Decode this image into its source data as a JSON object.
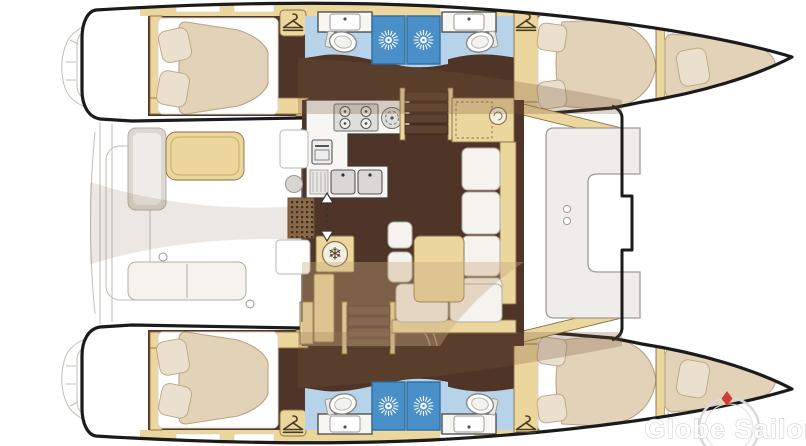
{
  "watermark": {
    "text": "Globe Sailor"
  },
  "icons": {
    "fridge_snowflake": "❄",
    "hanger": "clothes-hanger",
    "shower": "sunburst",
    "door_arrows": "up-down-arrow",
    "compass": "compass-rose"
  },
  "palette": {
    "outline": "#1b1b1b",
    "white": "#ffffff",
    "wood": "#ebd79e",
    "woodBorder": "#8a6f3f",
    "floorDark": "#4f3527",
    "bed": "#e2d2b8",
    "bedBorder": "#b9a485",
    "pillow": "#eae0cd",
    "cushion": "#f5f3ee",
    "cushionBorder": "#b2ada3",
    "benchGray": "#dcd8d1",
    "bathFloor": "#b7d3e9",
    "shower": "#4a8fc7",
    "showerBorder": "#2e6da4",
    "counter": "#f7f6f3",
    "counterBorder": "#3a3a38",
    "appliance": "#dededa",
    "applianceBorder": "#6f6f6b",
    "deckLine": "#c2beb7",
    "steps": "#5d4232",
    "overlay": "#7a573c",
    "overlayTan": "#c9a97f",
    "watermarkText": "#ffffff",
    "watermarkRing": "#d9d9d9",
    "compassRed": "#d23b2f"
  }
}
